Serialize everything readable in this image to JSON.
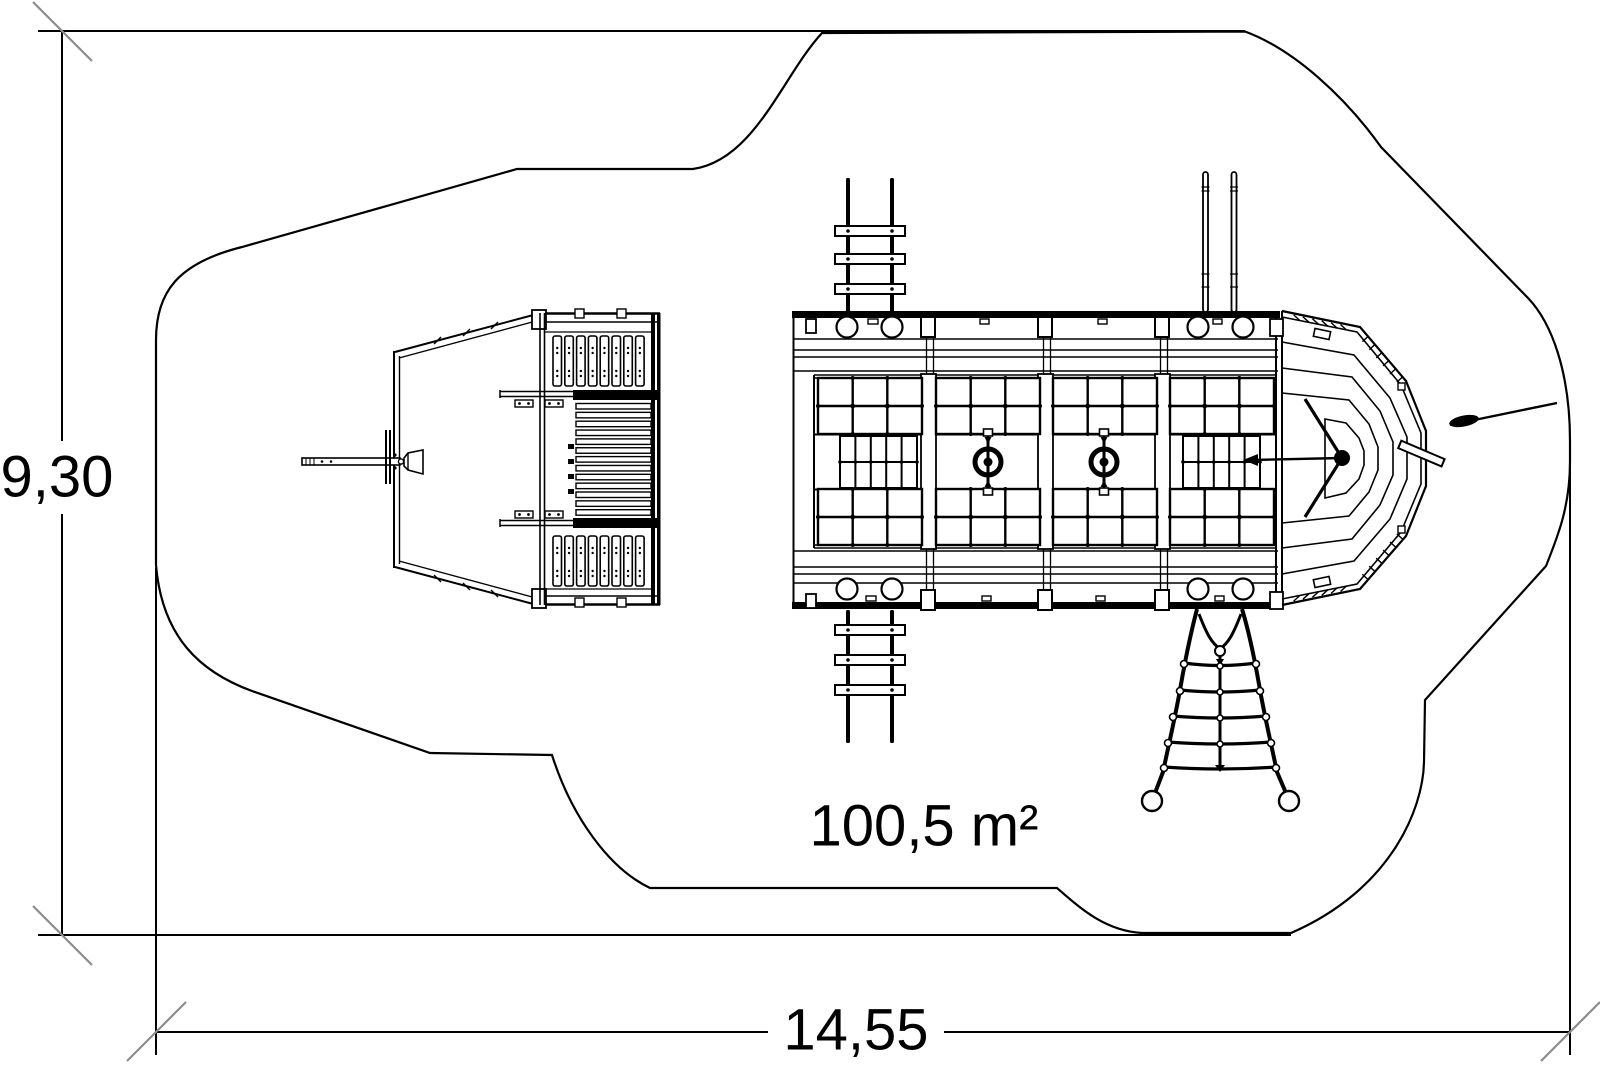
{
  "drawing": {
    "type_label": "playground pirate-ship top view plan",
    "area_label": "100,5 m²",
    "width_dimension": "14,55",
    "height_dimension": "9,30"
  },
  "colors": {
    "line": "#000000",
    "dimension_tick": "#8c8c8c",
    "background": "#ffffff"
  }
}
